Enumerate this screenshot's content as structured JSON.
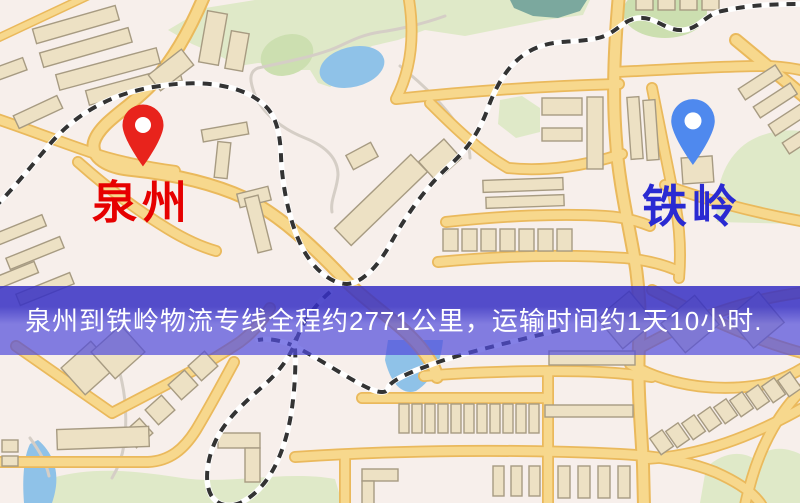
{
  "banner": {
    "text": "泉州到铁岭物流专线全程约2771公里，运输时间约1天10小时.",
    "description": "semi-transparent purple route info bar overlaid on map"
  },
  "markers": {
    "origin": {
      "label": "泉州",
      "pin": "red map pin with white dot"
    },
    "destination": {
      "label": "铁岭",
      "pin": "blue map pin with white dot"
    }
  },
  "icons": {
    "origin_pin": "map-pin-icon",
    "destination_pin": "map-pin-icon"
  },
  "theme": {
    "bg": "#f7efeb",
    "park": "#dfe9c8",
    "park_dark": "#ccdfb0",
    "water": "#8fc2e8",
    "teal": "#7ba89e",
    "road_casing": "#eab95c",
    "road_fill": "#f7d88d",
    "minor": "#d5cec6",
    "rail": "#333333",
    "rail_gap": "#ffffff",
    "building_fill": "#ede1c4",
    "building_stroke": "#a79b82",
    "banner_top": "rgba(54,48,196,0.85)",
    "banner_bottom": "rgba(80,75,219,0.70)",
    "banner_text": "#ffffff",
    "origin_label": "#e60000",
    "origin_pin": "#e8231c",
    "dest_label": "#2a2ad2",
    "dest_pin": "#4f89ee"
  }
}
